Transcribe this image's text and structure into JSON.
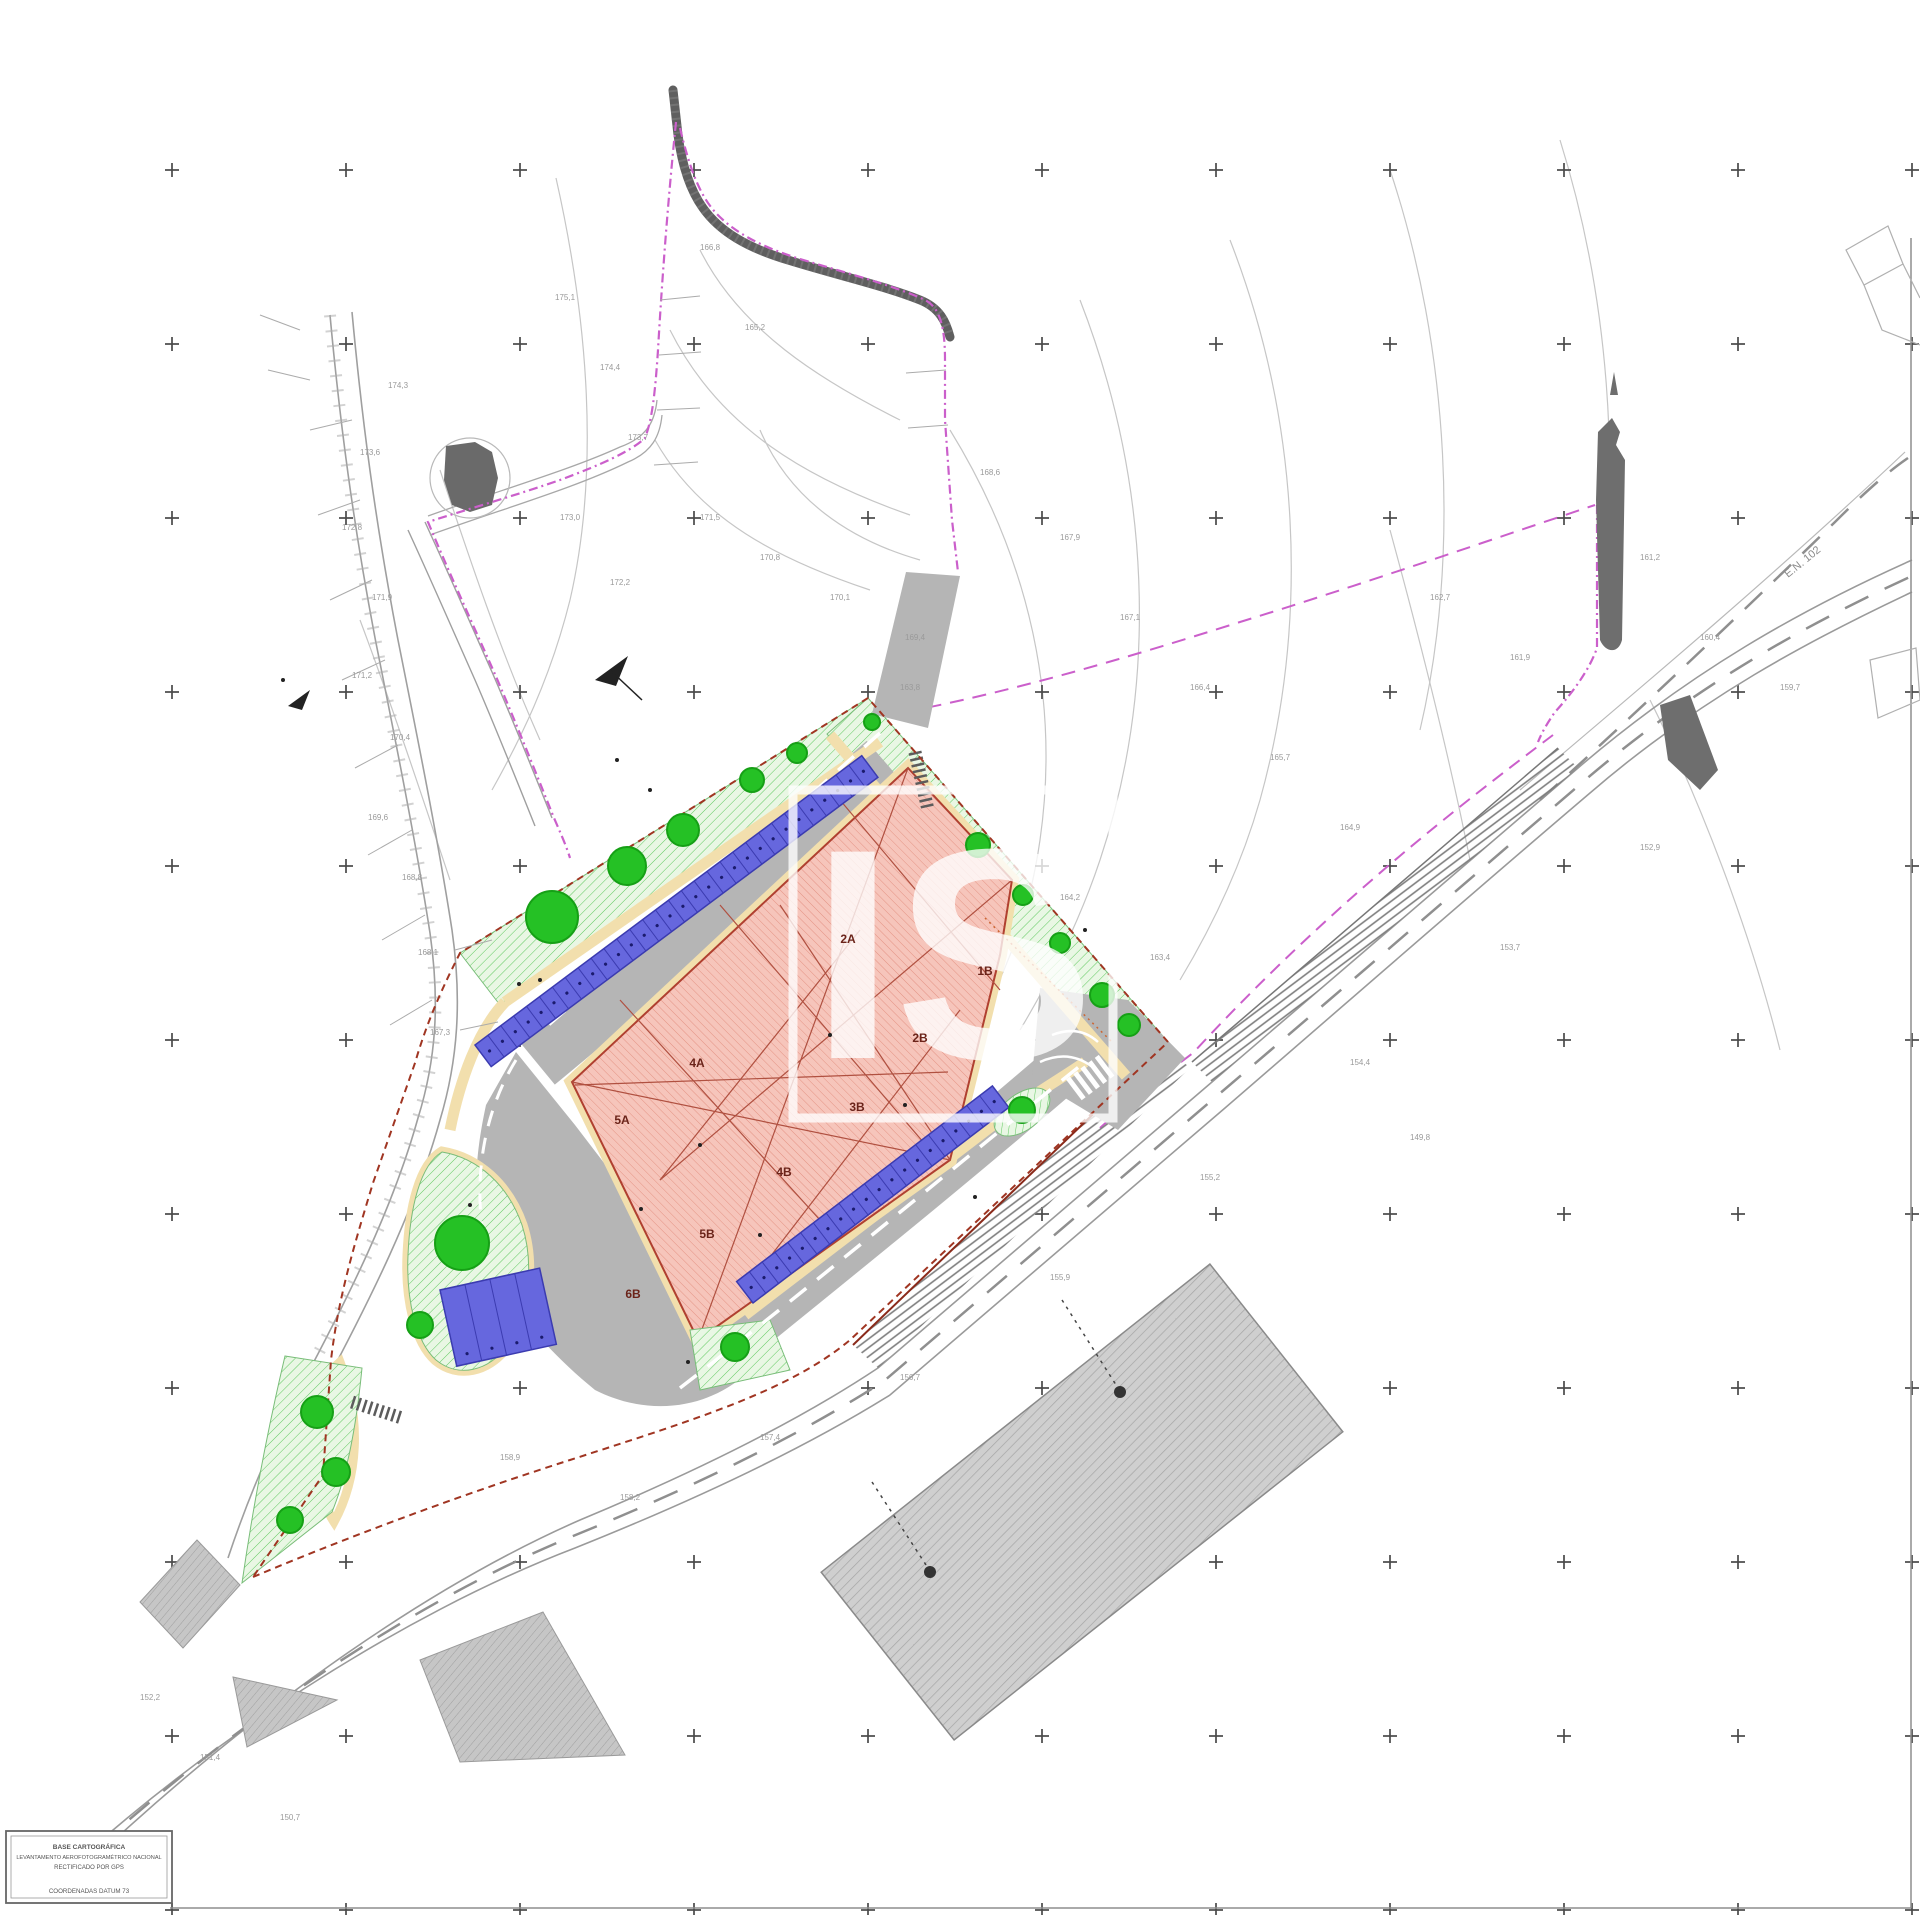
{
  "document": {
    "type_label": "cadastral site implantation plan"
  },
  "watermark": {
    "text": "IS"
  },
  "legend": {
    "line1": "BASE CARTOGRÁFICA",
    "line2": "LEVANTAMENTO AEROFOTOGRAMÉTRICO NACIONAL",
    "line3": "RECTIFICADO POR GPS",
    "line4": "COORDENADAS DATUM 73"
  },
  "road_label": "E.N. 102",
  "colors": {
    "parking_blue": "#6667de",
    "parking_blue_edge": "#3b3bb0",
    "tree_green": "#25c125",
    "tree_green_edge": "#16a016",
    "building_salmon": "#f4b8ae",
    "boundary_magenta": "#cb5fcb",
    "boundary_red": "#a03522",
    "curb_yellow": "#f2dfad",
    "road_gray": "#b5b5b5",
    "grid_cross": "#4a4a4a"
  },
  "grid": {
    "x0": 172,
    "y0": 170,
    "step": 174,
    "size": 14
  },
  "trees": [
    {
      "x": 872,
      "y": 722,
      "r": 8
    },
    {
      "x": 797,
      "y": 753,
      "r": 10
    },
    {
      "x": 752,
      "y": 780,
      "r": 12
    },
    {
      "x": 683,
      "y": 830,
      "r": 16
    },
    {
      "x": 627,
      "y": 866,
      "r": 19
    },
    {
      "x": 552,
      "y": 917,
      "r": 26
    },
    {
      "x": 978,
      "y": 845,
      "r": 12
    },
    {
      "x": 1023,
      "y": 895,
      "r": 10
    },
    {
      "x": 1060,
      "y": 943,
      "r": 10
    },
    {
      "x": 1102,
      "y": 995,
      "r": 12
    },
    {
      "x": 1129,
      "y": 1025,
      "r": 11
    },
    {
      "x": 462,
      "y": 1243,
      "r": 27
    },
    {
      "x": 420,
      "y": 1325,
      "r": 13
    },
    {
      "x": 317,
      "y": 1412,
      "r": 16
    },
    {
      "x": 336,
      "y": 1472,
      "r": 14
    },
    {
      "x": 290,
      "y": 1520,
      "r": 13
    },
    {
      "x": 735,
      "y": 1347,
      "r": 14
    },
    {
      "x": 1022,
      "y": 1110,
      "r": 13
    }
  ],
  "parking": {
    "rows": [
      {
        "x": 475,
        "y": 1045,
        "length": 483,
        "angle": -36.8,
        "stalls": 30,
        "width": 27,
        "side": 1
      },
      {
        "x": 753,
        "y": 1303,
        "length": 322,
        "angle": -37.4,
        "stalls": 20,
        "width": 27,
        "side": -1
      }
    ],
    "block": {
      "x": 440,
      "y": 1290,
      "angle": -12.4,
      "width": 102,
      "height": 78,
      "stalls": 4
    }
  },
  "building_labels": [
    {
      "text": "1B",
      "x": 985,
      "y": 975
    },
    {
      "text": "2B",
      "x": 920,
      "y": 1042
    },
    {
      "text": "2A",
      "x": 848,
      "y": 943
    },
    {
      "text": "3B",
      "x": 857,
      "y": 1111
    },
    {
      "text": "4A",
      "x": 697,
      "y": 1067
    },
    {
      "text": "4B",
      "x": 784,
      "y": 1176
    },
    {
      "text": "5A",
      "x": 622,
      "y": 1124
    },
    {
      "text": "5B",
      "x": 707,
      "y": 1238
    },
    {
      "text": "6B",
      "x": 633,
      "y": 1298
    }
  ],
  "elevation_labels": [
    {
      "text": "174,3",
      "x": 388,
      "y": 388
    },
    {
      "text": "173,6",
      "x": 360,
      "y": 455
    },
    {
      "text": "172,8",
      "x": 342,
      "y": 530
    },
    {
      "text": "171,9",
      "x": 372,
      "y": 600
    },
    {
      "text": "171,2",
      "x": 352,
      "y": 678
    },
    {
      "text": "170,4",
      "x": 390,
      "y": 740
    },
    {
      "text": "169,6",
      "x": 368,
      "y": 820
    },
    {
      "text": "168,8",
      "x": 402,
      "y": 880
    },
    {
      "text": "168,1",
      "x": 418,
      "y": 955
    },
    {
      "text": "167,3",
      "x": 430,
      "y": 1035
    },
    {
      "text": "175,1",
      "x": 555,
      "y": 300
    },
    {
      "text": "174,4",
      "x": 600,
      "y": 370
    },
    {
      "text": "173,7",
      "x": 628,
      "y": 440
    },
    {
      "text": "173,0",
      "x": 560,
      "y": 520
    },
    {
      "text": "172,2",
      "x": 610,
      "y": 585
    },
    {
      "text": "171,5",
      "x": 700,
      "y": 520
    },
    {
      "text": "170,8",
      "x": 760,
      "y": 560
    },
    {
      "text": "170,1",
      "x": 830,
      "y": 600
    },
    {
      "text": "169,4",
      "x": 905,
      "y": 640
    },
    {
      "text": "168,6",
      "x": 980,
      "y": 475
    },
    {
      "text": "167,9",
      "x": 1060,
      "y": 540
    },
    {
      "text": "167,1",
      "x": 1120,
      "y": 620
    },
    {
      "text": "166,4",
      "x": 1190,
      "y": 690
    },
    {
      "text": "165,7",
      "x": 1270,
      "y": 760
    },
    {
      "text": "164,9",
      "x": 1340,
      "y": 830
    },
    {
      "text": "164,2",
      "x": 1060,
      "y": 900
    },
    {
      "text": "163,4",
      "x": 1150,
      "y": 960
    },
    {
      "text": "162,7",
      "x": 1430,
      "y": 600
    },
    {
      "text": "161,9",
      "x": 1510,
      "y": 660
    },
    {
      "text": "161,2",
      "x": 1640,
      "y": 560
    },
    {
      "text": "160,4",
      "x": 1700,
      "y": 640
    },
    {
      "text": "159,7",
      "x": 1780,
      "y": 690
    },
    {
      "text": "158,9",
      "x": 500,
      "y": 1460
    },
    {
      "text": "158,2",
      "x": 620,
      "y": 1500
    },
    {
      "text": "157,4",
      "x": 760,
      "y": 1440
    },
    {
      "text": "156,7",
      "x": 900,
      "y": 1380
    },
    {
      "text": "155,9",
      "x": 1050,
      "y": 1280
    },
    {
      "text": "155,2",
      "x": 1200,
      "y": 1180
    },
    {
      "text": "154,4",
      "x": 1350,
      "y": 1065
    },
    {
      "text": "153,7",
      "x": 1500,
      "y": 950
    },
    {
      "text": "152,9",
      "x": 1640,
      "y": 850
    },
    {
      "text": "152,2",
      "x": 140,
      "y": 1700
    },
    {
      "text": "151,4",
      "x": 200,
      "y": 1760
    },
    {
      "text": "150,7",
      "x": 280,
      "y": 1820
    },
    {
      "text": "166,8",
      "x": 700,
      "y": 250
    },
    {
      "text": "165,2",
      "x": 745,
      "y": 330
    },
    {
      "text": "163,8",
      "x": 900,
      "y": 690
    },
    {
      "text": "149,8",
      "x": 1410,
      "y": 1140
    }
  ],
  "dots": [
    {
      "x": 617,
      "y": 760
    },
    {
      "x": 650,
      "y": 790
    },
    {
      "x": 700,
      "y": 1145
    },
    {
      "x": 760,
      "y": 1235
    },
    {
      "x": 830,
      "y": 1035
    },
    {
      "x": 905,
      "y": 1105
    },
    {
      "x": 540,
      "y": 980
    },
    {
      "x": 470,
      "y": 1205
    },
    {
      "x": 688,
      "y": 1362
    },
    {
      "x": 975,
      "y": 1197
    },
    {
      "x": 1085,
      "y": 930
    },
    {
      "x": 283,
      "y": 680
    },
    {
      "x": 519,
      "y": 984
    },
    {
      "x": 641,
      "y": 1209
    }
  ],
  "parcel_ticks": [
    [
      352,
      420,
      310,
      430
    ],
    [
      360,
      500,
      318,
      515
    ],
    [
      372,
      580,
      330,
      600
    ],
    [
      385,
      660,
      342,
      680
    ],
    [
      398,
      745,
      355,
      768
    ],
    [
      412,
      830,
      368,
      855
    ],
    [
      425,
      915,
      382,
      940
    ],
    [
      432,
      1000,
      390,
      1025
    ],
    [
      300,
      330,
      260,
      315
    ],
    [
      310,
      380,
      268,
      370
    ],
    [
      455,
      950,
      492,
      940
    ],
    [
      460,
      1030,
      498,
      1022
    ],
    [
      660,
      300,
      700,
      296
    ],
    [
      659,
      355,
      701,
      352
    ],
    [
      657,
      410,
      700,
      408
    ],
    [
      654,
      465,
      698,
      462
    ],
    [
      946,
      370,
      906,
      373
    ],
    [
      948,
      425,
      908,
      428
    ]
  ]
}
